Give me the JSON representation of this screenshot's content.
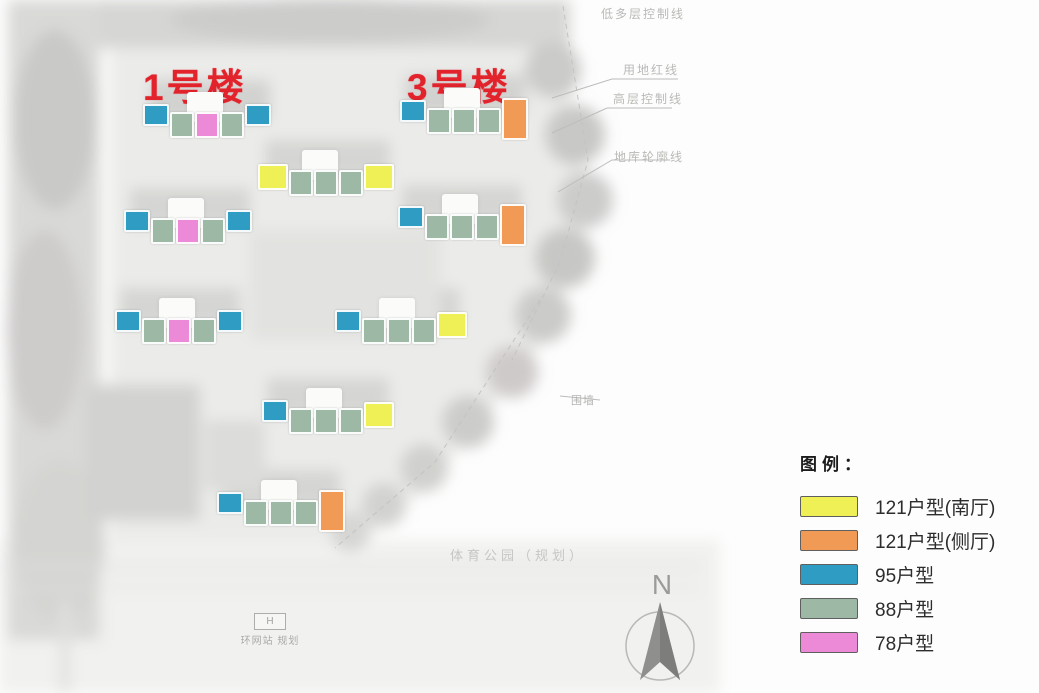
{
  "palette": {
    "types": {
      "95": {
        "color": "#2f9cc4",
        "w": 26,
        "h": 22,
        "mt": 0
      },
      "88": {
        "color": "#9db8a5",
        "w": 24,
        "h": 26,
        "mt": 8
      },
      "78": {
        "color": "#ec8ad8",
        "w": 24,
        "h": 26,
        "mt": 8
      },
      "121s": {
        "color": "#eef056",
        "w": 30,
        "h": 26,
        "mt": 2
      },
      "121c": {
        "color": "#f09a55",
        "w": 26,
        "h": 42,
        "mt": -2
      }
    },
    "label_red": "#e2232c",
    "annotation_gray": "#b9b9b6"
  },
  "site_plan": {
    "building_labels": [
      {
        "text": "1号楼",
        "x": 143,
        "y": 57
      },
      {
        "text": "3号楼",
        "x": 407,
        "y": 57
      }
    ],
    "buildings": [
      {
        "name": "building-1",
        "x": 143,
        "y": 104,
        "blocks": [
          "95",
          "88",
          "78",
          "88",
          "95"
        ]
      },
      {
        "name": "building-3",
        "x": 400,
        "y": 100,
        "blocks": [
          "95",
          "88",
          "88",
          "88",
          "121c"
        ]
      },
      {
        "name": "building-row2-mid",
        "x": 258,
        "y": 162,
        "blocks": [
          "121s",
          "88",
          "88",
          "88",
          "121s"
        ]
      },
      {
        "name": "building-row2-left",
        "x": 124,
        "y": 210,
        "blocks": [
          "95",
          "88",
          "78",
          "88",
          "95"
        ]
      },
      {
        "name": "building-row2-right",
        "x": 398,
        "y": 206,
        "blocks": [
          "95",
          "88",
          "88",
          "88",
          "121c"
        ]
      },
      {
        "name": "building-row3-left",
        "x": 115,
        "y": 310,
        "blocks": [
          "95",
          "88",
          "78",
          "88",
          "95"
        ]
      },
      {
        "name": "building-row3-right",
        "x": 335,
        "y": 310,
        "blocks": [
          "95",
          "88",
          "88",
          "88",
          "121s"
        ]
      },
      {
        "name": "building-row4-mid",
        "x": 262,
        "y": 400,
        "blocks": [
          "95",
          "88",
          "88",
          "88",
          "121s"
        ]
      },
      {
        "name": "building-row5",
        "x": 217,
        "y": 492,
        "blocks": [
          "95",
          "88",
          "88",
          "88",
          "121c"
        ]
      }
    ],
    "annotations": [
      {
        "text": "低多层控制线",
        "x": 601,
        "y": 5,
        "variant": "default"
      },
      {
        "text": "用地红线",
        "x": 623,
        "y": 61,
        "variant": "default"
      },
      {
        "text": "高层控制线",
        "x": 613,
        "y": 90,
        "variant": "default"
      },
      {
        "text": "地库轮廓线",
        "x": 614,
        "y": 148,
        "variant": "default"
      },
      {
        "text": "围墙",
        "x": 571,
        "y": 392,
        "variant": "wall"
      },
      {
        "text": "体育公园（规划）",
        "x": 450,
        "y": 545,
        "variant": "park"
      }
    ],
    "utility_station": {
      "box_label": "H",
      "caption": "环网站 规划"
    },
    "compass": {
      "label": "N"
    }
  },
  "legend": {
    "title": "图例：",
    "items": [
      {
        "label": "121户型(南厅)",
        "color": "#eef056",
        "type": "121s"
      },
      {
        "label": "121户型(侧厅)",
        "color": "#f09a55",
        "type": "121c"
      },
      {
        "label": "95户型",
        "color": "#2f9cc4",
        "type": "95"
      },
      {
        "label": "88户型",
        "color": "#9db8a5",
        "type": "88"
      },
      {
        "label": "78户型",
        "color": "#ec8ad8",
        "type": "78"
      }
    ]
  }
}
